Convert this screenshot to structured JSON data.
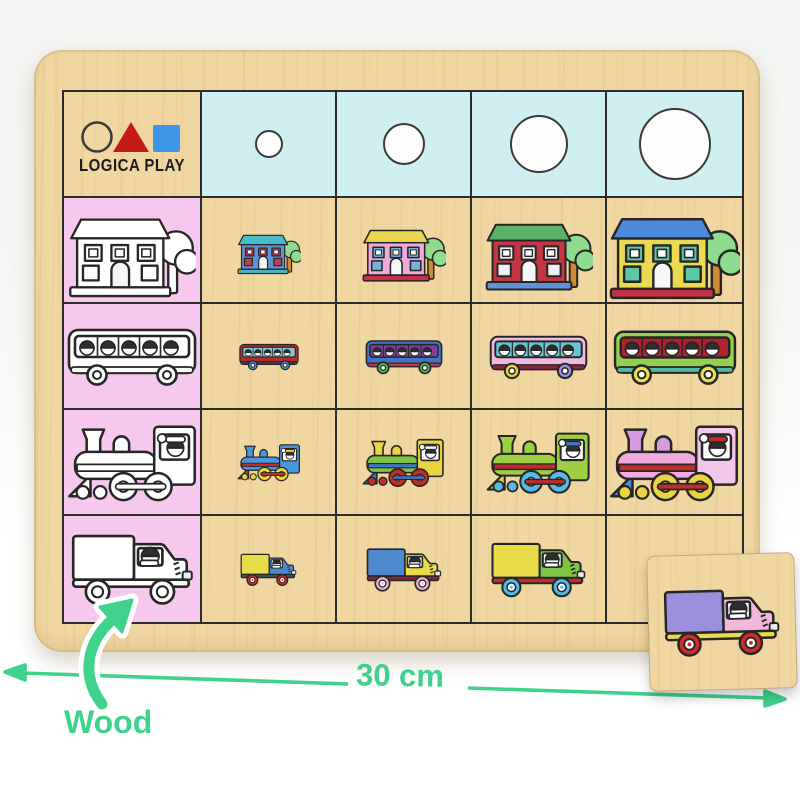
{
  "brand": {
    "name": "LOGICA PLAY",
    "logo_shapes": [
      "circle",
      "triangle",
      "square"
    ],
    "logo_colors": {
      "circle_outline": "#3c3c3c",
      "triangle": "#c41a1a",
      "square": "#3f96e8"
    }
  },
  "annotations": {
    "width_label": "30 cm",
    "material_label": "Wood",
    "color": "#3ed28c"
  },
  "page_colors": {
    "background_top": "#f3f3f1",
    "background_bottom": "#ffffff"
  },
  "board": {
    "wood_color": "#f0d6a1",
    "wood_streak_color": "#cda462",
    "size_header_color": "#cfeff1",
    "sample_column_color": "#f6c8ee",
    "grid_line_color": "#2c2c2c",
    "outline_fill": "#ffffff",
    "size_circle_diameters_px": [
      26,
      40,
      56,
      70
    ],
    "items": [
      "house",
      "bus",
      "train",
      "truck"
    ],
    "art": {
      "house": {
        "viewBox": "0 0 130 100",
        "base_w": 128,
        "vars": [
          "roof",
          "wall",
          "win",
          "base",
          "tree",
          "trunk"
        ]
      },
      "bus": {
        "viewBox": "0 0 130 62",
        "base_w": 124,
        "vars": [
          "body",
          "band",
          "wheel",
          "wheel2",
          "accent"
        ]
      },
      "train": {
        "viewBox": "0 0 135 85",
        "base_w": 128,
        "vars": [
          "body",
          "body2",
          "cab",
          "wheel",
          "rod",
          "accent",
          "cap"
        ]
      },
      "truck": {
        "viewBox": "0 0 125 75",
        "base_w": 118,
        "vars": [
          "box",
          "cab",
          "wheel",
          "fender",
          "hub"
        ]
      }
    },
    "rows": [
      {
        "cells": [
          {
            "kind": "logo",
            "bg": "wood",
            "name": "logo-cell"
          },
          {
            "kind": "circle",
            "d": 26,
            "bg": "blue",
            "name": "size-circle-cell-1"
          },
          {
            "kind": "circle",
            "d": 40,
            "bg": "blue",
            "name": "size-circle-cell-2"
          },
          {
            "kind": "circle",
            "d": 56,
            "bg": "blue",
            "name": "size-circle-cell-3"
          },
          {
            "kind": "circle",
            "d": 70,
            "bg": "blue",
            "name": "size-circle-cell-4"
          }
        ]
      },
      {
        "cells": [
          {
            "kind": "art",
            "item": "house",
            "variant": "outline",
            "scale": 1.0,
            "bg": "pink",
            "name": "sample-house-cell"
          },
          {
            "kind": "art",
            "item": "house",
            "scale": 0.5,
            "bg": "wood",
            "name": "house-cell-size-1",
            "colors": {
              "roof": "#49bcc9",
              "wall": "#5e93d8",
              "win": "#c23c52",
              "base": "#4db3be",
              "tree": "#8fdc8f",
              "trunk": "#cf8b33"
            }
          },
          {
            "kind": "art",
            "item": "house",
            "scale": 0.66,
            "bg": "wood",
            "name": "house-cell-size-2",
            "colors": {
              "roof": "#e9d44c",
              "wall": "#efaad9",
              "win": "#79b1e2",
              "base": "#c43246",
              "tree": "#8fdc8f",
              "trunk": "#cf8b33"
            }
          },
          {
            "kind": "art",
            "item": "house",
            "scale": 0.84,
            "bg": "wood",
            "name": "house-cell-size-3",
            "colors": {
              "roof": "#5ab269",
              "wall": "#c13642",
              "win": "#eef0f2",
              "base": "#5e93d8",
              "tree": "#8fdc8f",
              "trunk": "#cf8b33"
            }
          },
          {
            "kind": "art",
            "item": "house",
            "scale": 1.02,
            "bg": "wood",
            "name": "house-cell-size-4",
            "colors": {
              "roof": "#4d89dd",
              "wall": "#e9da52",
              "win": "#5cc9a6",
              "base": "#c43246",
              "tree": "#8fdc8f",
              "trunk": "#cf8b33"
            }
          }
        ]
      },
      {
        "cells": [
          {
            "kind": "art",
            "item": "bus",
            "variant": "outline",
            "scale": 1.05,
            "bg": "pink",
            "name": "sample-bus-cell"
          },
          {
            "kind": "art",
            "item": "bus",
            "scale": 0.48,
            "bg": "wood",
            "name": "bus-cell-size-1",
            "colors": {
              "body": "#b9292f",
              "band": "#84c6cf",
              "wheel": "#4d89cc",
              "wheel2": "#4d89cc",
              "accent": "#3e3e3e"
            }
          },
          {
            "kind": "art",
            "item": "bus",
            "scale": 0.63,
            "bg": "wood",
            "name": "bus-cell-size-2",
            "colors": {
              "body": "#4076c5",
              "band": "#7e3f9d",
              "wheel": "#54b34a",
              "wheel2": "#54b34a",
              "accent": "#c43246"
            }
          },
          {
            "kind": "art",
            "item": "bus",
            "scale": 0.8,
            "bg": "wood",
            "name": "bus-cell-size-3",
            "colors": {
              "body": "#f0badd",
              "band": "#6ac4d4",
              "wheel": "#e5d23f",
              "wheel2": "#9c8cdb",
              "accent": "#8e2340"
            }
          },
          {
            "kind": "art",
            "item": "bus",
            "scale": 1.0,
            "bg": "wood",
            "name": "bus-cell-size-4",
            "colors": {
              "body": "#93d14e",
              "band": "#b2222d",
              "wheel": "#e9e04c",
              "wheel2": "#e9e04c",
              "accent": "#4fb9a6"
            }
          }
        ]
      },
      {
        "cells": [
          {
            "kind": "art",
            "item": "train",
            "variant": "outline",
            "scale": 1.02,
            "bg": "pink",
            "name": "sample-train-cell"
          },
          {
            "kind": "art",
            "item": "train",
            "scale": 0.5,
            "bg": "wood",
            "name": "train-cell-size-1",
            "colors": {
              "body": "#4897de",
              "body2": "#4897de",
              "cab": "#4897de",
              "wheel": "#ead43f",
              "rod": "#c22d28",
              "accent": "#c22d28",
              "cap": "#ead43f"
            }
          },
          {
            "kind": "art",
            "item": "train",
            "scale": 0.65,
            "bg": "wood",
            "name": "train-cell-size-2",
            "colors": {
              "body": "#7fc444",
              "body2": "#ead43f",
              "cab": "#ead43f",
              "wheel": "#c22d28",
              "rod": "#4076c5",
              "accent": "#4076c5",
              "cap": "#f4f4f4"
            }
          },
          {
            "kind": "art",
            "item": "train",
            "scale": 0.82,
            "bg": "wood",
            "name": "train-cell-size-3",
            "colors": {
              "body": "#9ccf42",
              "body2": "#9ccf42",
              "cab": "#9ccf42",
              "wheel": "#57b9e6",
              "rod": "#c22d28",
              "accent": "#ead43f",
              "cap": "#4076c5"
            }
          },
          {
            "kind": "art",
            "item": "train",
            "scale": 1.02,
            "bg": "wood",
            "name": "train-cell-size-4",
            "colors": {
              "body": "#f0abdf",
              "body2": "#d89ae0",
              "cab": "#f4c6ec",
              "wheel": "#ead43f",
              "rod": "#c22d28",
              "accent": "#4d89dd",
              "cap": "#c22d28"
            }
          }
        ]
      },
      {
        "cells": [
          {
            "kind": "art",
            "item": "truck",
            "variant": "outline",
            "scale": 1.08,
            "bg": "pink",
            "name": "sample-truck-cell"
          },
          {
            "kind": "art",
            "item": "truck",
            "scale": 0.5,
            "bg": "wood",
            "name": "truck-cell-size-1",
            "colors": {
              "box": "#e9dc48",
              "cab": "#4d89cc",
              "wheel": "#c22d28",
              "fender": "#4a4a4a",
              "hub": "#ffffff"
            }
          },
          {
            "kind": "art",
            "item": "truck",
            "scale": 0.66,
            "bg": "wood",
            "name": "truck-cell-size-2",
            "colors": {
              "box": "#4d89cc",
              "cab": "#e9dc48",
              "wheel": "#f0accd",
              "fender": "#8e2340",
              "hub": "#ffffff"
            }
          },
          {
            "kind": "art",
            "item": "truck",
            "scale": 0.84,
            "bg": "wood",
            "name": "truck-cell-size-3",
            "colors": {
              "box": "#e9dc48",
              "cab": "#7fc444",
              "wheel": "#57b9e6",
              "fender": "#c22d28",
              "hub": "#ffffff"
            }
          },
          {
            "kind": "empty",
            "bg": "wood",
            "name": "empty-piece-slot"
          }
        ]
      }
    ]
  },
  "loose_piece": {
    "item": "truck",
    "scale": 1.02,
    "name": "removed-piece-truck",
    "colors": {
      "box": "#9c8fdc",
      "cab": "#f2b8dc",
      "wheel": "#d42a26",
      "fender": "#e9dc48",
      "hub": "#ffffff"
    }
  }
}
